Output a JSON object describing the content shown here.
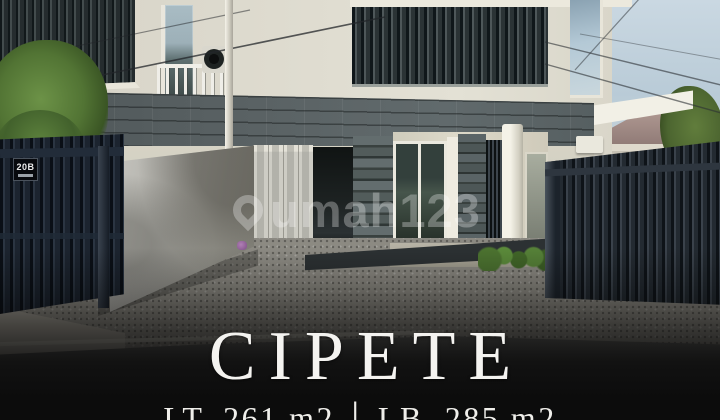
{
  "overlay": {
    "title": "CIPETE",
    "specs": {
      "land": "LT. 261 m2",
      "separator": "|",
      "building": "LB. 285 m2"
    }
  },
  "watermark": {
    "text": "umah123"
  },
  "photo": {
    "house_number": "20B"
  },
  "colors": {
    "sky": "#b9cbd7",
    "facade": "#dedbcf",
    "stone": "#596163",
    "gate": "#1c242f",
    "driveway": "#908e86",
    "road": "#434343",
    "shade": "#0c0c0c"
  }
}
